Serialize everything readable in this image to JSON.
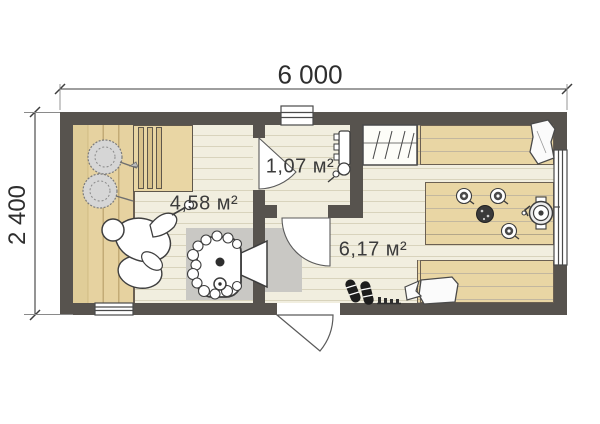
{
  "plan": {
    "title": "bathhouse-floor-plan",
    "dimensions": {
      "width_label": "6 000",
      "height_label": "2 400"
    },
    "rooms": [
      {
        "name": "sauna",
        "area_label": "4,58 м²"
      },
      {
        "name": "shower-room",
        "area_label": "1,07 м²"
      },
      {
        "name": "rest-room",
        "area_label": "6,17 м²"
      }
    ],
    "elements": [
      "sauna-bench",
      "upper-bench",
      "bath-brooms",
      "person-on-bench",
      "sauna-stove",
      "stove-platform",
      "shower-unit",
      "coat-closet",
      "wall-bench-top",
      "wall-bench-bottom",
      "pillows",
      "dining-table",
      "tea-cups",
      "plate",
      "samovar",
      "shoes",
      "shoe-rack",
      "entrance-door",
      "interior-doors",
      "windows"
    ],
    "colors": {
      "wall": "#57534e",
      "floor": "#f1eedf",
      "floor-line": "#d8d3bc",
      "wood": "#e9d6a4",
      "bench": "#e6d2a0",
      "platform": "#c9c8c4",
      "outline": "#3d3d3d",
      "text": "#3b3b3b"
    }
  }
}
